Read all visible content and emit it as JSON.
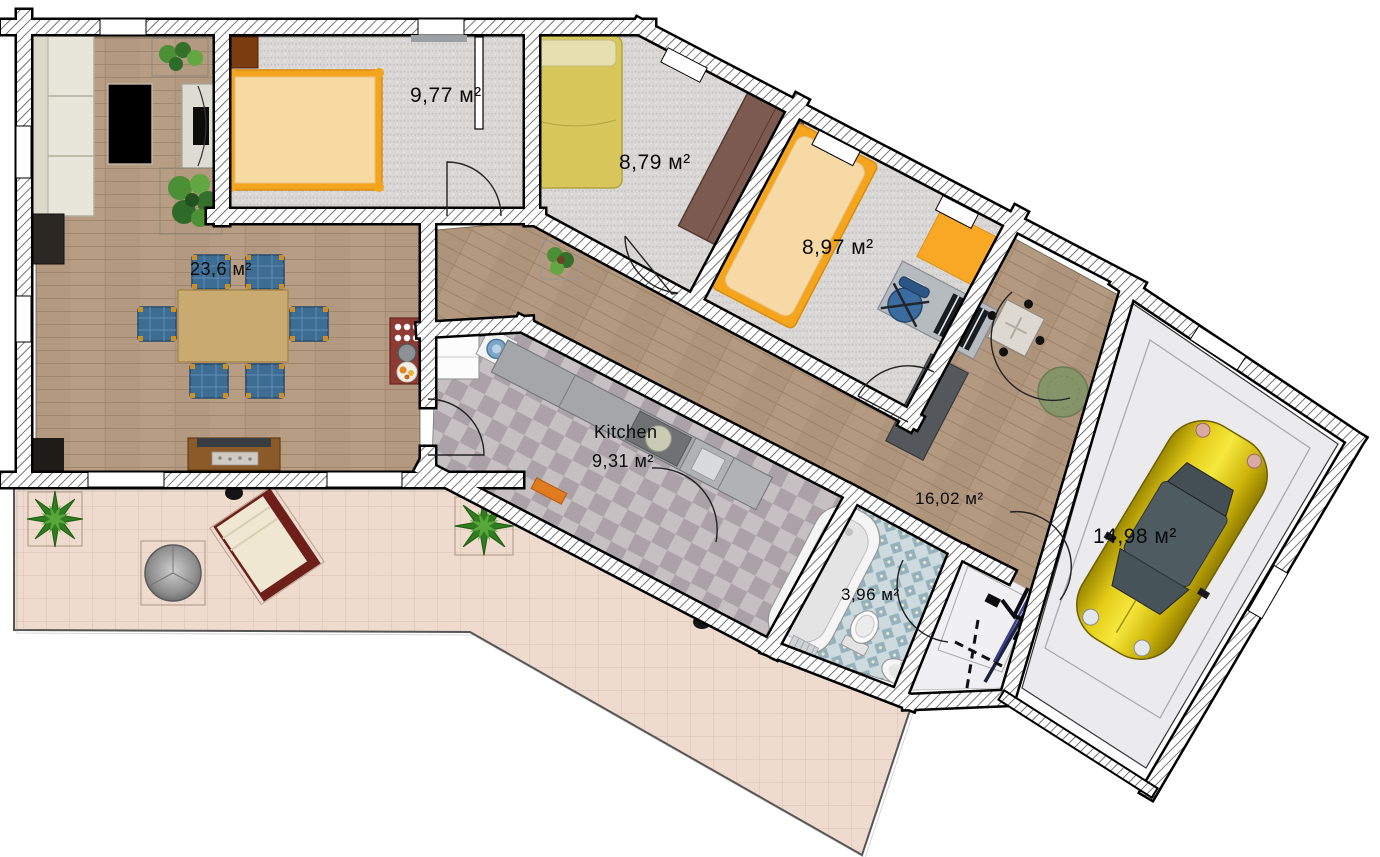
{
  "floor_plan": {
    "unit_suffix": "м²",
    "rooms": [
      {
        "id": "bedroom-top",
        "area_label": "9,77 м²"
      },
      {
        "id": "bedroom-middle",
        "area_label": "8,79 м²"
      },
      {
        "id": "bedroom-right",
        "area_label": "8,97 м²"
      },
      {
        "id": "living-room",
        "area_label": "23,6 м²"
      },
      {
        "id": "kitchen",
        "name_label": "Kitchen",
        "area_label": "9,31 м²"
      },
      {
        "id": "hallway",
        "area_label": "16,02 м²"
      },
      {
        "id": "bathroom",
        "area_label": "3,96 м²"
      },
      {
        "id": "garage",
        "area_label": "14,98 м²"
      }
    ],
    "colors": {
      "wall_fill": "#ffffff",
      "wall_line": "#000000",
      "wood_floor": "#b49a83",
      "carpet_floor": "#d8d7d5",
      "kitchen_tile_dark": "#aaa2a6",
      "kitchen_tile_light": "#c6c0c3",
      "bath_tile_base": "#cddade",
      "bath_tile_diamond": "#93b2bc",
      "terrace_tile": "#eedbce",
      "garage_floor": "#ebebee",
      "bed_frame_orange": "#f5a51d",
      "bed_mattress": "#f7d9a2",
      "bed_yellow": "#d7c65a",
      "chair_blue": "#3e6d94",
      "wardrobe_brown": "#7d5a50",
      "car_yellow": "#d8bd00",
      "plant_green": "#2f7d1f"
    },
    "furniture": [
      "sofa",
      "coffee-table",
      "tv-stand",
      "dining-table",
      "dining-chairs",
      "fireplace-sideboard",
      "stove",
      "double-bed-orange",
      "bedside-cabinet",
      "double-bed-yellow",
      "wardrobe",
      "single-bed-orange",
      "orange-rug",
      "desk-piano",
      "office-chair",
      "fridge",
      "washing-machine",
      "kitchen-counter",
      "bathtub",
      "toilet",
      "sink",
      "ski-set",
      "car",
      "round-rug",
      "hall-table",
      "hall-sideboard",
      "grill",
      "lounge-chair",
      "star-plant",
      "potted-plant",
      "door-mat"
    ]
  }
}
